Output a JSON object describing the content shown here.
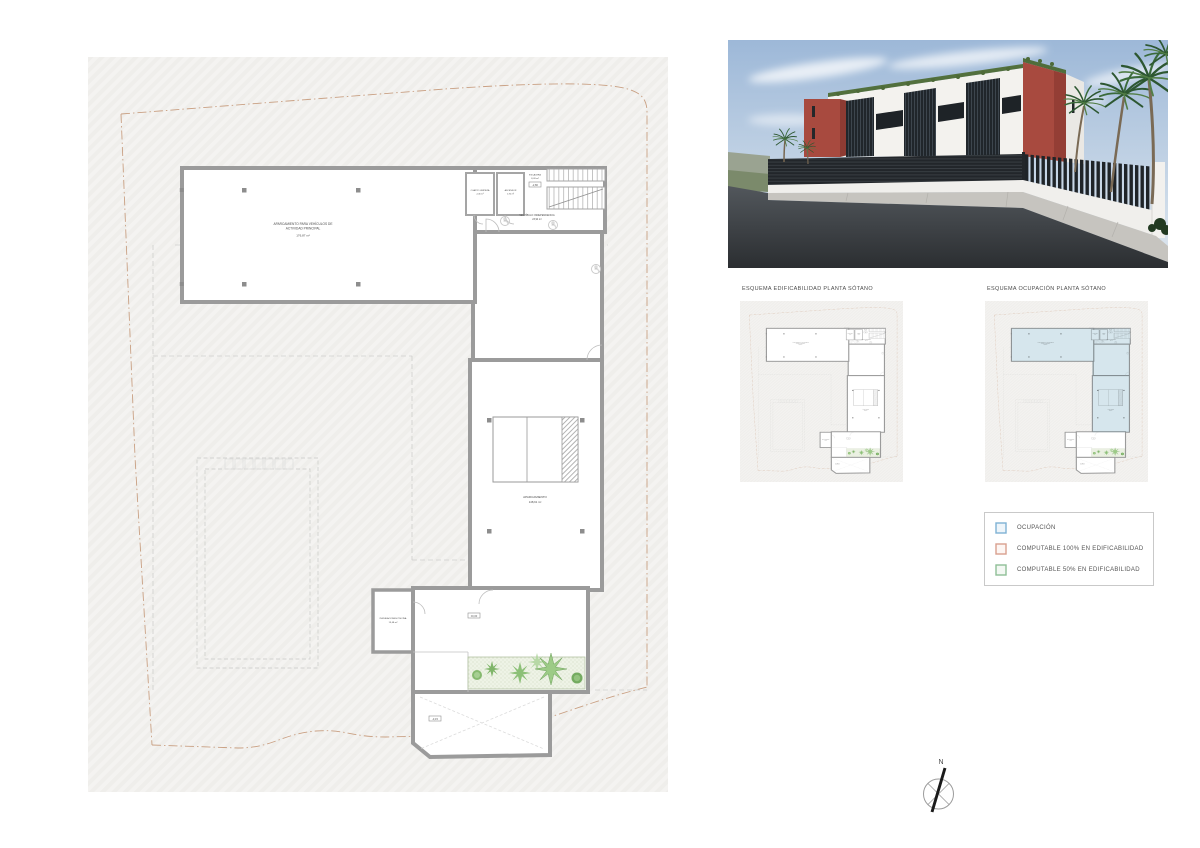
{
  "sheet": {
    "background": "#ffffff"
  },
  "main_plan": {
    "labels": {
      "parking_line1": "APARCAMIENTO PARA VEHÍCULOS DE",
      "parking_line2": "ACTIVIDAD PRINCIPAL",
      "parking_area": "176,87 m²",
      "cuarto_limpieza": "CUARTO LIMPIEZA",
      "cuarto_limpieza_area": "2,46 m²",
      "ascensor": "ASCENSOR",
      "ascensor_area": "1,92 m²",
      "escalera": "ESCALERA",
      "escalera_area": "8,09 m²",
      "escalera_level": "-2,80",
      "vestibulo": "VESTÍBULO INDEPENDENCIA",
      "vestibulo_area": "23,94 m²",
      "aparcamiento": "APARCAMIENTO",
      "aparcamiento_area": "148,91 m²",
      "instalaciones": "INSTALACIONES PISCINA",
      "instalaciones_area": "13,48 m²",
      "level_patio": "±0,00",
      "level_rampa": "-3,15"
    }
  },
  "schematics": {
    "edificabilidad_title": "ESQUEMA EDIFICABILIDAD PLANTA SÓTANO",
    "ocupacion_title": "ESQUEMA OCUPACIÓN PLANTA SÓTANO",
    "ocupacion_fill": "#cfe2ea"
  },
  "legend": {
    "items": [
      {
        "label": "OCUPACIÓN",
        "stroke": "#7fb2d4",
        "fill": "#eef5fa"
      },
      {
        "label": "COMPUTABLE 100% EN EDIFICABILIDAD",
        "stroke": "#d9a08f",
        "fill": "#fdf6f3"
      },
      {
        "label": "COMPUTABLE 50% EN EDIFICABILIDAD",
        "stroke": "#8fbf97",
        "fill": "#f3f8f3"
      }
    ]
  },
  "compass": {
    "north_label": "N"
  },
  "render_colors": {
    "sky": "#9db8d8",
    "building_red": "#a84a3f",
    "building_white": "#f3f2ee",
    "fence_dark": "#22262a",
    "road": "#3c4043",
    "palm_green": "#2d5731"
  }
}
